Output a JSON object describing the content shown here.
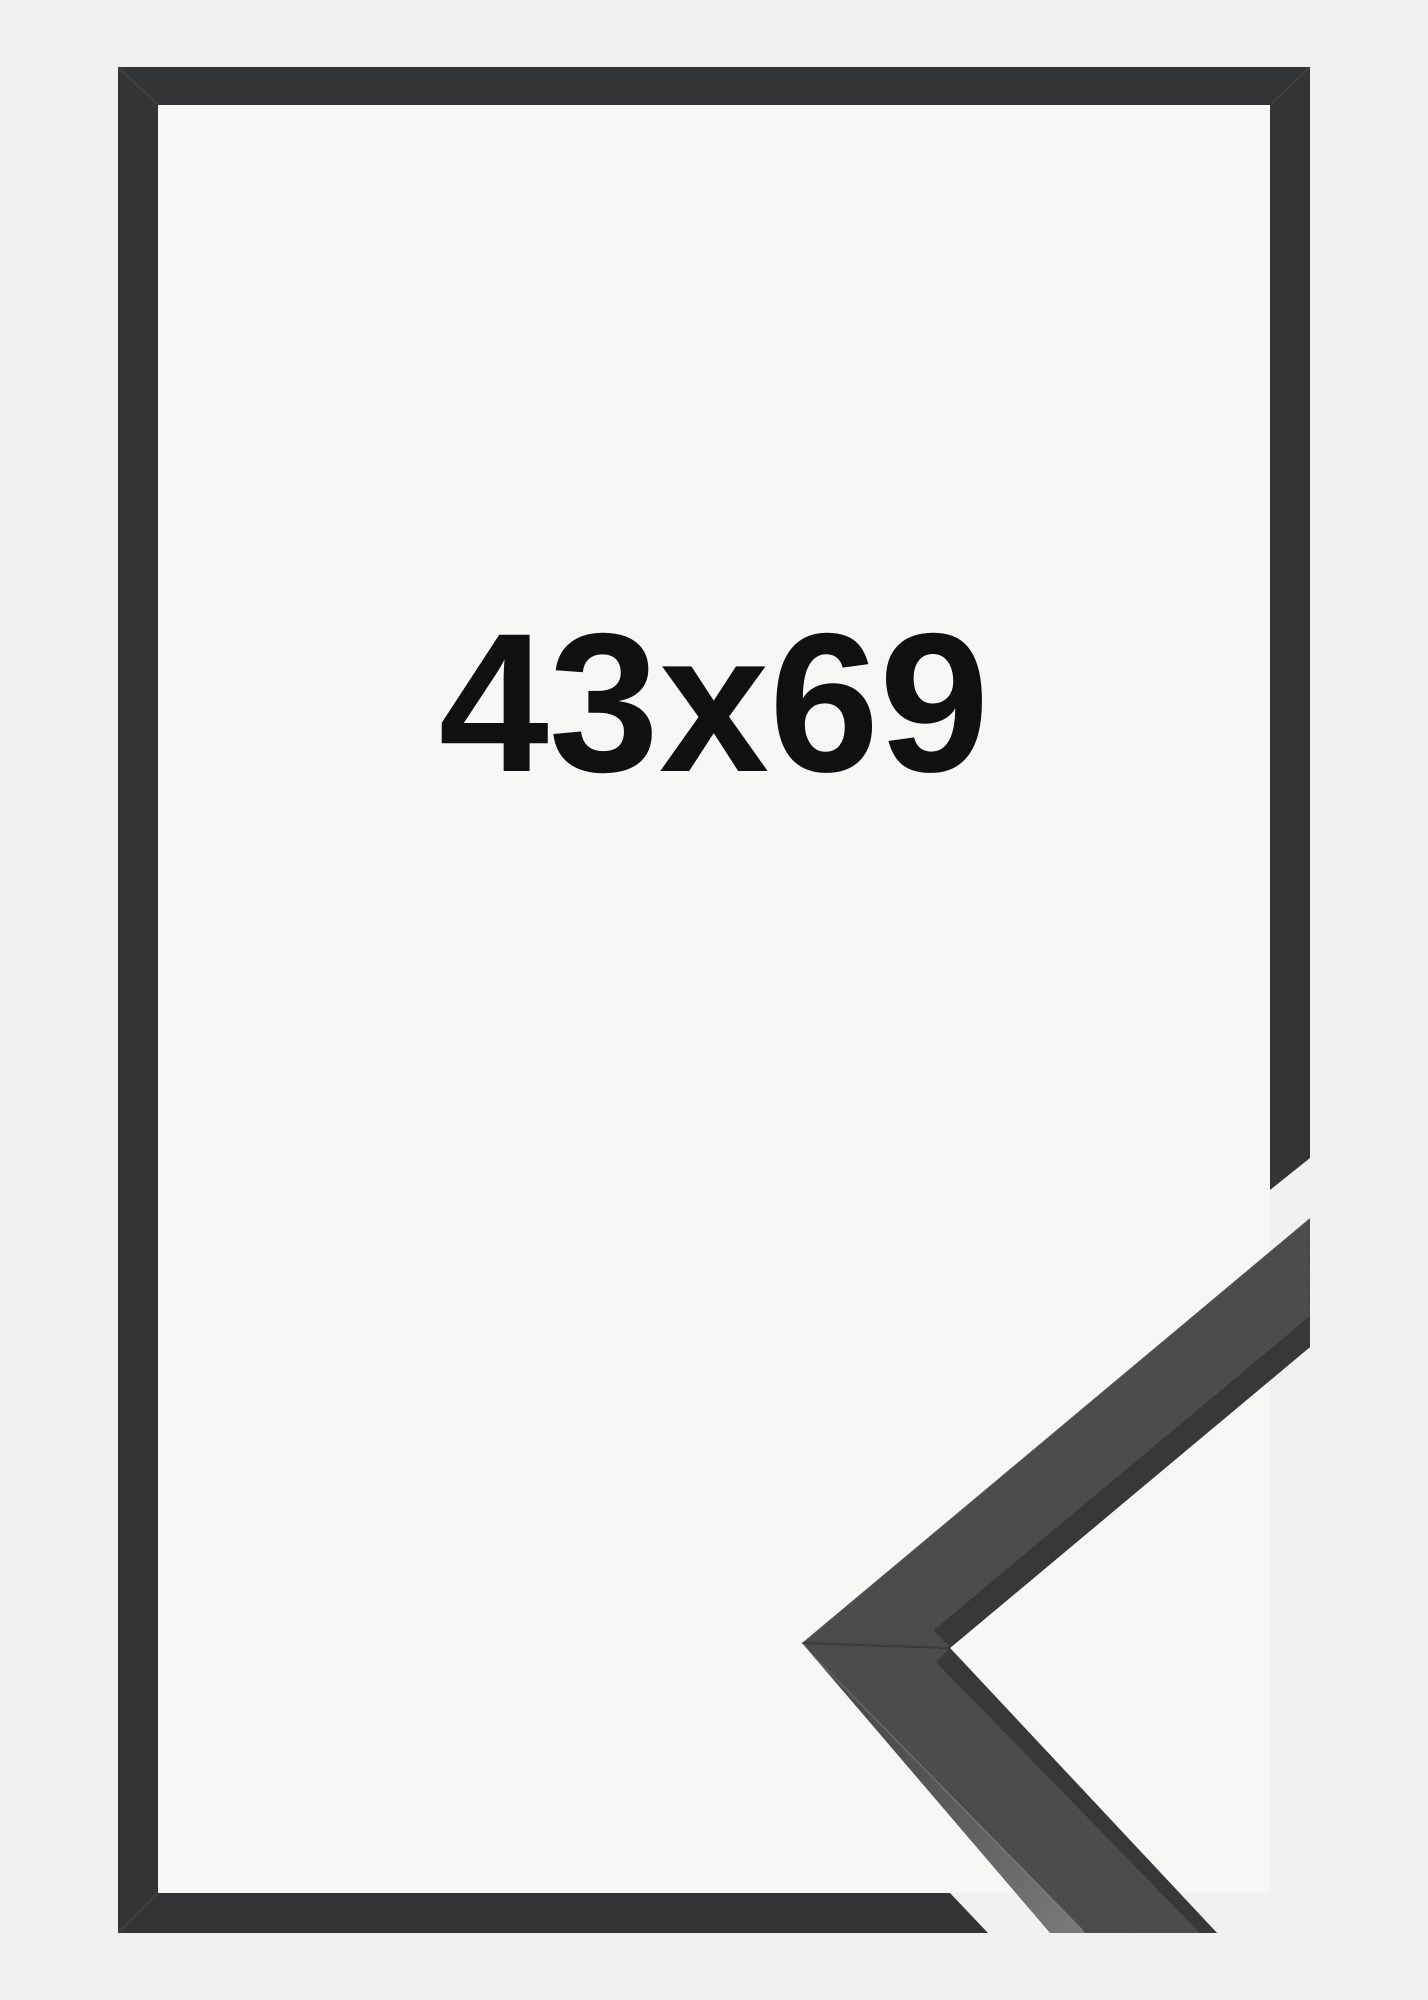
{
  "product_image": {
    "size_label": "43x69",
    "colors": {
      "background": "#f0f1f0",
      "frame_interior": "#f7f7f6",
      "frame": "#333435",
      "moulding_top_face": "#424344",
      "moulding_inner_edge": "#2d2e2f",
      "moulding_side_tip": "#3a3b3c",
      "moulding_side_end": "#737475",
      "label_text": "#101010"
    }
  }
}
